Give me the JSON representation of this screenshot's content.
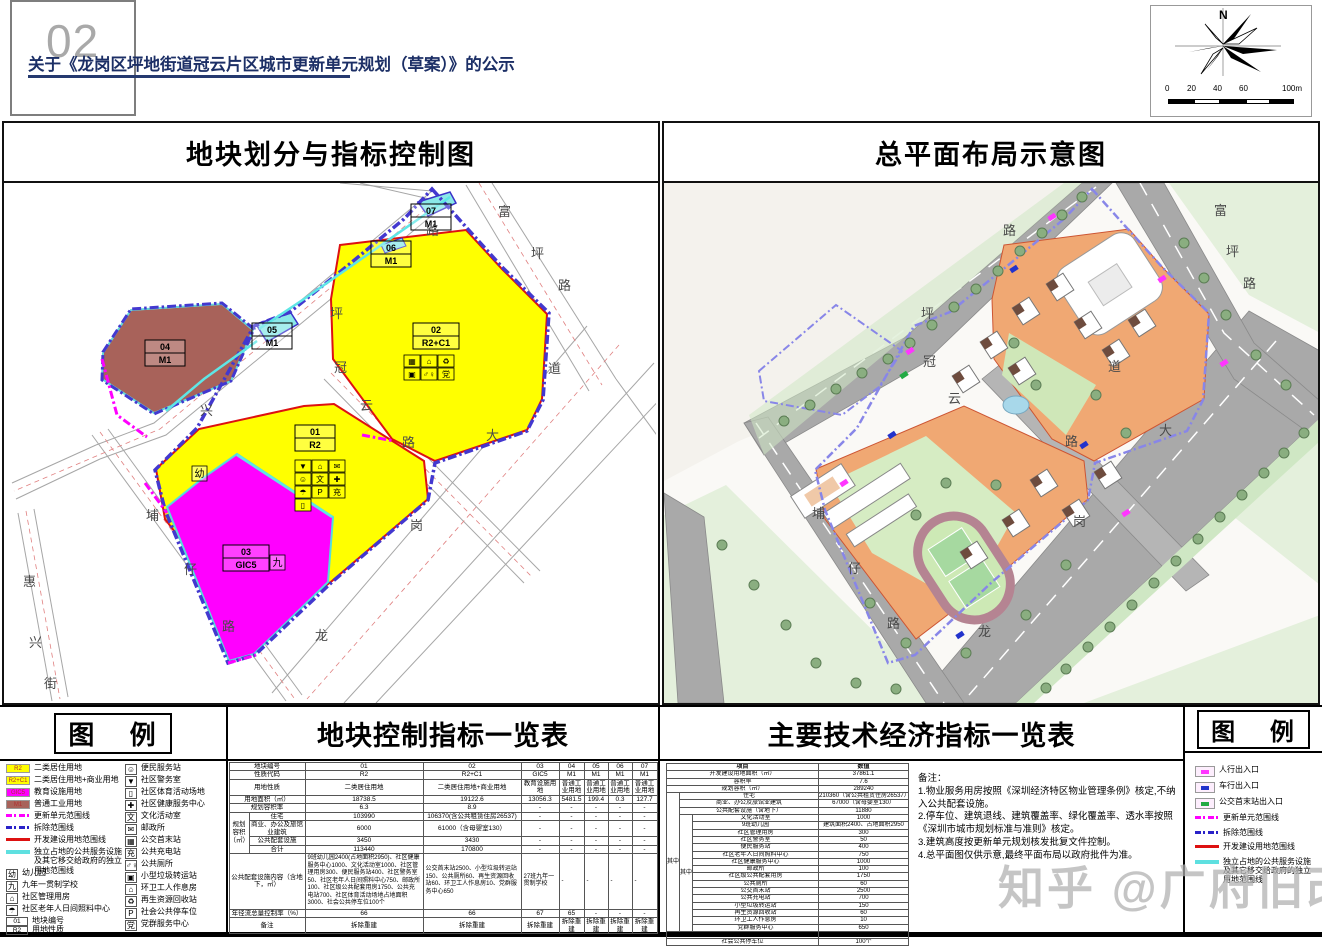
{
  "header": {
    "page_number": "02",
    "title": "关于《龙岗区坪地街道冠云片区城市更新单元规划（草案）》的公示",
    "compass": {
      "north_label": "N",
      "scale_labels": [
        "0",
        "20",
        "40",
        "60",
        "100m"
      ]
    }
  },
  "left_panel": {
    "title": "地块划分与指标控制图",
    "plots": [
      {
        "id": "01",
        "code": "R2"
      },
      {
        "id": "02",
        "code": "R2+C1"
      },
      {
        "id": "03",
        "code": "GIC5"
      },
      {
        "id": "04",
        "code": "M1"
      },
      {
        "id": "05",
        "code": "M1"
      },
      {
        "id": "06",
        "code": "M1"
      },
      {
        "id": "07",
        "code": "M1"
      }
    ],
    "special_glyphs": {
      "kindergarten": "幼",
      "school": "九"
    },
    "road_labels": [
      "富",
      "坪",
      "路",
      "路",
      "坪",
      "兴",
      "冠",
      "云",
      "路",
      "道",
      "大",
      "岗",
      "龙",
      "埔",
      "仔",
      "路",
      "惠",
      "兴",
      "街"
    ],
    "plot01_icons": [
      {
        "g": "▼",
        "icon": "police-room"
      },
      {
        "g": "⌂",
        "icon": "community-management"
      },
      {
        "g": "✉",
        "icon": "post-office"
      },
      {
        "g": "☺",
        "icon": "convenience-station"
      },
      {
        "g": "文",
        "icon": "culture-room"
      },
      {
        "g": "✚",
        "icon": "health-center"
      },
      {
        "g": "☂",
        "icon": "elderly-care"
      },
      {
        "g": "P",
        "icon": "public-parking"
      },
      {
        "g": "充",
        "icon": "charging-station"
      },
      {
        "g": "▯",
        "icon": "sports-ground"
      }
    ],
    "plot02_icons": [
      {
        "g": "▦",
        "icon": "bus-terminus"
      },
      {
        "g": "⌂",
        "icon": "community-house"
      },
      {
        "g": "♻",
        "icon": "recycling-station"
      },
      {
        "g": "▣",
        "icon": "waste-transfer"
      },
      {
        "g": "♂♀",
        "icon": "public-toilet"
      },
      {
        "g": "党",
        "icon": "party-service-center"
      }
    ]
  },
  "right_panel": {
    "title": "总平面布局示意图",
    "road_labels": [
      "富",
      "坪",
      "路",
      "路",
      "坪",
      "冠",
      "云",
      "道",
      "大",
      "路",
      "岗",
      "龙",
      "埔",
      "仔",
      "路"
    ]
  },
  "legend_left": {
    "title": "图  例",
    "col1": [
      {
        "type": "area",
        "color": "#ffff00",
        "key": "R2",
        "icon": "residential-landuse",
        "label": "二类居住用地"
      },
      {
        "type": "area",
        "color": "#ffff00",
        "key": "R2+C1",
        "icon": "residential-commercial-landuse",
        "label": "二类居住用地+商业用地"
      },
      {
        "type": "area",
        "color": "#ff00ff",
        "key": "GIC5",
        "icon": "education-landuse",
        "label": "教育设施用地"
      },
      {
        "type": "area",
        "color": "#a8625a",
        "key": "M1",
        "icon": "industrial-landuse",
        "label": "普通工业用地"
      },
      {
        "type": "line",
        "style": "line-dash-magenta",
        "icon": "renewal-unit-boundary",
        "label": "更新单元范围线"
      },
      {
        "type": "line",
        "style": "line-dash-blue",
        "icon": "demolition-boundary",
        "label": "拆除范围线"
      },
      {
        "type": "line",
        "style": "line-solid-red",
        "icon": "development-land-boundary",
        "label": "开发建设用地范围线"
      },
      {
        "type": "line",
        "style": "line-solid-cyan",
        "icon": "independent-public-land-boundary",
        "label": "独立占地的公共服务设施及其它移交给政府的独立用地范围线"
      },
      {
        "type": "glyph",
        "key": "幼",
        "icon": "kindergarten",
        "label": "幼儿园"
      },
      {
        "type": "glyph",
        "key": "九",
        "icon": "nine-year-school",
        "label": "九年一贯制学校"
      },
      {
        "type": "glyph",
        "key": "⌂",
        "icon": "community-management",
        "label": "社区管理用房"
      },
      {
        "type": "glyph",
        "key": "☂",
        "icon": "elderly-care",
        "label": "社区老年人日间照料中心"
      },
      {
        "type": "stack",
        "key_top": "01",
        "key_bottom": "R2",
        "icon": "plot-label-sample",
        "label_top": "地块编号",
        "label_bottom": "用地性质"
      }
    ],
    "col2": [
      {
        "type": "glyph",
        "key": "☺",
        "icon": "convenience-station",
        "label": "便民服务站"
      },
      {
        "type": "glyph",
        "key": "▼",
        "icon": "police-room",
        "label": "社区警务室"
      },
      {
        "type": "glyph",
        "key": "▯",
        "icon": "sports-ground",
        "label": "社区体育活动场地"
      },
      {
        "type": "glyph",
        "key": "✚",
        "icon": "health-center",
        "label": "社区健康服务中心"
      },
      {
        "type": "glyph",
        "key": "文",
        "icon": "culture-room",
        "label": "文化活动室"
      },
      {
        "type": "glyph",
        "key": "✉",
        "icon": "post-office",
        "label": "邮政所"
      },
      {
        "type": "glyph",
        "key": "▦",
        "icon": "bus-terminus",
        "label": "公交首末站"
      },
      {
        "type": "glyph",
        "key": "充",
        "icon": "charging-station",
        "label": "公共充电站"
      },
      {
        "type": "glyph",
        "key": "♂♀",
        "icon": "public-toilet",
        "label": "公共厕所"
      },
      {
        "type": "glyph",
        "key": "▣",
        "icon": "waste-transfer",
        "label": "小型垃圾转运站"
      },
      {
        "type": "glyph",
        "key": "⌂",
        "icon": "sanitation-rest-room",
        "label": "环卫工人作息房"
      },
      {
        "type": "glyph",
        "key": "♻",
        "icon": "recycling-station",
        "label": "再生资源回收站"
      },
      {
        "type": "glyph",
        "key": "P",
        "icon": "public-parking",
        "label": "社会公共停车位"
      },
      {
        "type": "glyph",
        "key": "党",
        "icon": "party-service-center",
        "label": "党群服务中心"
      }
    ]
  },
  "plot_table": {
    "title": "地块控制指标一览表",
    "rows": [
      {
        "label": "地块编号",
        "values": [
          "01",
          "02",
          "03",
          "04",
          "05",
          "06",
          "07"
        ]
      },
      {
        "label": "性质代码",
        "values": [
          "R2",
          "R2+C1",
          "GIC5",
          "M1",
          "M1",
          "M1",
          "M1"
        ]
      },
      {
        "label": "用地性质",
        "values": [
          "二类居住用地",
          "二类居住用地+商业用地",
          "教育设施用地",
          "普通工业用地",
          "普通工业用地",
          "普通工业用地",
          "普通工业用地"
        ]
      },
      {
        "label": "用地面积（㎡）",
        "values": [
          "18738.5",
          "19122.6",
          "13056.3",
          "5481.5",
          "199.4",
          "0.3",
          "127.7"
        ]
      },
      {
        "label": "规划容积率",
        "values": [
          "6.3",
          "8.9",
          "-",
          "-",
          "-",
          "-",
          "-"
        ]
      },
      {
        "group": "规划容积（㎡）",
        "label": "住宅",
        "values": [
          "103990",
          "106370(含公共租赁住房26537)",
          "-",
          "-",
          "-",
          "-",
          "-"
        ]
      },
      {
        "group": "",
        "label": "商业、办公及旅馆业建筑",
        "values": [
          "6000",
          "61000（含母婴室130）",
          "-",
          "-",
          "-",
          "-",
          "-"
        ]
      },
      {
        "group": "",
        "label": "公共配套设施",
        "values": [
          "3450",
          "3430",
          "-",
          "-",
          "-",
          "-",
          "-"
        ]
      },
      {
        "group": "",
        "label": "合计",
        "values": [
          "113440",
          "170800",
          "-",
          "-",
          "-",
          "-",
          "-"
        ]
      },
      {
        "label": "公共配套设施内容（含地下，㎡）",
        "content": true,
        "values": [
          "9班幼儿园2400(占地面积2950)、社区健康服务中心1000、文化活动室1000、社区管理用房300、便民服务站400、社区警务室50、社区老年人日间照料中心750、邮政所100、社区级公共配套用房1750、公共充电站700、社区体育活动场地占地面积3000、社会公共停车位100个",
          "公交首末站2500、小型垃圾转运站150、公共厕所60、再生资源回收站60、环卫工人作息房10、党群服务中心650",
          "27班九年一贯制学校",
          "-",
          "-",
          "-",
          "-"
        ]
      },
      {
        "label": "年径流总量控制率（%）",
        "values": [
          "66",
          "66",
          "67",
          "65",
          "-",
          "-",
          "-"
        ]
      },
      {
        "label": "备注",
        "values": [
          "拆除重建",
          "拆除重建",
          "拆除重建",
          "拆除重建",
          "拆除重建",
          "拆除重建",
          "拆除重建"
        ]
      }
    ]
  },
  "econ_table": {
    "title": "主要技术经济指标一览表",
    "header": [
      "项目",
      "数值"
    ],
    "outer_span_label": "其中",
    "inner_span_label": "其中",
    "rows": [
      {
        "label": "开发建设用地面积（㎡）",
        "value": "37861.1",
        "level": 0
      },
      {
        "label": "容积率",
        "value": "7.6",
        "level": 0
      },
      {
        "label": "规划容积（㎡）",
        "value": "289240",
        "level": 0
      },
      {
        "label": "住宅",
        "value": "210360（含公共租赁住房26537）",
        "level": 1
      },
      {
        "label": "商业、办公及旅馆业建筑",
        "value": "67000（含母婴室130）",
        "level": 1
      },
      {
        "label": "公共配套设施（含地下）",
        "value": "11880",
        "level": 1
      },
      {
        "label": "文化活动室",
        "value": "1000",
        "level": 2
      },
      {
        "label": "9班幼儿园",
        "value": "建筑面积2400、占地面积2950",
        "level": 2
      },
      {
        "label": "社区管理用房",
        "value": "300",
        "level": 2
      },
      {
        "label": "社区警务室",
        "value": "50",
        "level": 2
      },
      {
        "label": "便民服务站",
        "value": "400",
        "level": 2
      },
      {
        "label": "社区老年人日间照料中心",
        "value": "750",
        "level": 2
      },
      {
        "label": "社区健康服务中心",
        "value": "1000",
        "level": 2
      },
      {
        "label": "邮政所",
        "value": "100",
        "level": 2
      },
      {
        "label": "社区级公共配套用房",
        "value": "1750",
        "level": 2
      },
      {
        "label": "公共厕所",
        "value": "60",
        "level": 2
      },
      {
        "label": "公交首末站",
        "value": "2500",
        "level": 2
      },
      {
        "label": "公共充电站",
        "value": "700",
        "level": 2
      },
      {
        "label": "小型垃圾转运站",
        "value": "150",
        "level": 2
      },
      {
        "label": "再生资源回收站",
        "value": "60",
        "level": 2
      },
      {
        "label": "环卫工人作息房",
        "value": "10",
        "level": 2
      },
      {
        "label": "党群服务中心",
        "value": "650",
        "level": 2
      },
      {
        "label": "社区体育活动场地",
        "value": "占地面积3000",
        "level": 0
      },
      {
        "label": "社会公共停车位",
        "value": "100个",
        "level": 0
      }
    ],
    "notes_title": "备注：",
    "notes": [
      "1.物业服务用房按照《深圳经济特区物业管理条例》核定,不纳入公共配套设施。",
      "2.停车位、建筑退线、建筑覆盖率、绿化覆盖率、透水率按照《深圳市城市规划标准与准则》核定。",
      "3.建筑高度按更新单元规划核发批复文件控制。",
      "4.总平面图仅供示意,最终平面布局以政府批件为准。"
    ]
  },
  "legend_right": {
    "title": "图  例",
    "items": [
      {
        "type": "marker",
        "color": "#ff35ff",
        "icon": "pedestrian-entrance-marker",
        "label": "人行出入口"
      },
      {
        "type": "marker",
        "color": "#2233cc",
        "icon": "vehicle-entrance-marker",
        "label": "车行出入口"
      },
      {
        "type": "marker",
        "color": "#22aa44",
        "icon": "bus-terminus-entrance-marker",
        "label": "公交首末站出入口"
      },
      {
        "type": "line",
        "style": "line-dash-magenta",
        "icon": "renewal-unit-boundary",
        "label": "更新单元范围线"
      },
      {
        "type": "line",
        "style": "line-dash-blue",
        "icon": "demolition-boundary",
        "label": "拆除范围线"
      },
      {
        "type": "line",
        "style": "line-solid-red",
        "icon": "development-land-boundary",
        "label": "开发建设用地范围线"
      },
      {
        "type": "line",
        "style": "line-solid-cyan",
        "icon": "independent-public-land-boundary",
        "label": "独立占地的公共服务设施及其它移交给政府的独立用地范围线"
      }
    ]
  },
  "watermark": "知乎 @广府旧改",
  "colors": {
    "residential": "#ffff00",
    "education": "#ff00ff",
    "industrial": "#a8625a",
    "renewal_boundary": "#ff00ff",
    "demolition_boundary": "#2a22c8",
    "development_boundary": "#dd1111",
    "independent_boundary": "#5ee0e0",
    "title_navy": "#1c2f66",
    "road_gray": "#a9a9a9",
    "plaza_orange": "#f0a873"
  }
}
